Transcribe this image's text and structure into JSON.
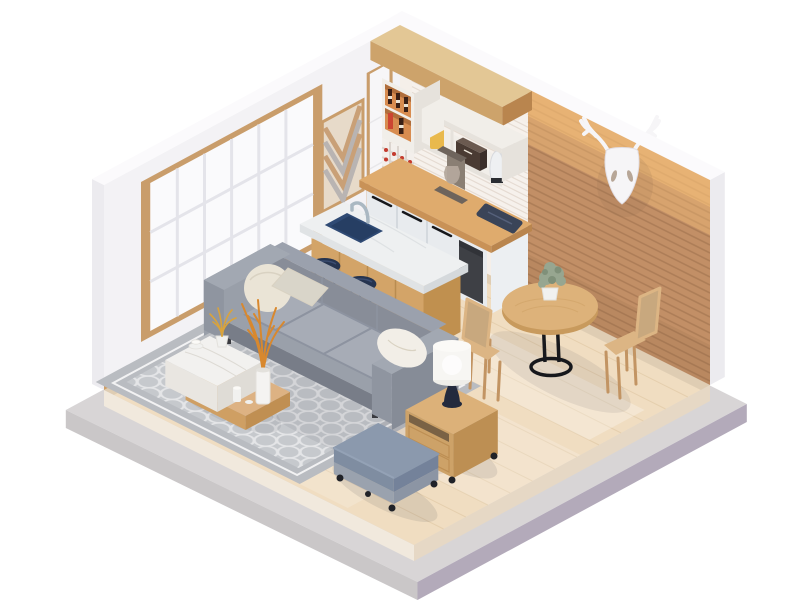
{
  "scene": {
    "title": "Isometric 3D render of a small studio apartment",
    "description": "Low-poly style room with white shoji window wall, brick accent wall, kitchenette, marble island with bar stools, round dining set, gray sofa with pillows, patterned rug, coffee table, ottoman and side table with lamp",
    "background": "#ffffff"
  },
  "objects": {
    "labels": [
      "platform",
      "wood-floor",
      "left-wall",
      "shoji-window",
      "chevron-art",
      "door-panel",
      "kitchen-wall",
      "tile-backsplash",
      "brick-wall",
      "deer-head-decor",
      "kitchen-soffit",
      "corner-shelf",
      "wine-rack",
      "wall-shelf",
      "yellow-canister",
      "bread-box",
      "kettle",
      "kitchen-counter",
      "coffee-maker",
      "serving-tray",
      "mini-fridge",
      "kitchen-island",
      "sink",
      "faucet",
      "bar-stools",
      "area-rug",
      "dining-table",
      "dining-chairs",
      "table-plant",
      "sofa",
      "pillows",
      "coffee-table",
      "vase-with-branches",
      "side-table",
      "table-lamp",
      "ottoman"
    ]
  },
  "colors": {
    "bg": "#ffffff",
    "platform_top": "#d8d5d6",
    "platform_left": "#cac7c8",
    "platform_right": "#b3aaba",
    "floor_top": "#f0ddc1",
    "floor_side_left": "#f1e9dd",
    "floor_side_right": "#e6d8c5",
    "plank": "#e0c8a5",
    "sun": "#ffffff",
    "wall_left": "#f3f2f5",
    "wall_kitchen": "#f5efe9",
    "wall_top": "#fbfafc",
    "wall_outer": "#ecebef",
    "baseboard": "#cf9f67",
    "window_frame": "#c99d6b",
    "pane": "#fafafc",
    "mullion": "#e4e4ea",
    "door_frame": "#c99d6b",
    "door_panel": "#f7f6f8",
    "door_line": "#e8e7ea",
    "chevron_base": "#e7dac9",
    "chevron_wood": "#c9a077",
    "chevron_gray": "#b9b4b2",
    "tile_base": "#f6f1ec",
    "tile_line": "#e5dbd2",
    "brick_base": "#c28f66",
    "brick_line": "#9b6e4b",
    "brick_glow": "#ffc87e",
    "brick_shadow": "#6b4a33",
    "deer_white": "#f6f5f7",
    "deer_line": "#e2dee4",
    "deer_dark": "#a8927e",
    "deer_shadow": "#8a6a4e",
    "soffit_face": "#cda36b",
    "soffit_top": "#e3c795",
    "soffit_end": "#b9854e",
    "shelf_white": "#f1eee9",
    "shelf_side": "#e6e2dc",
    "cubby_orange": "#d88c50",
    "cubby_shadow": "#b06e3c",
    "bottle_dark": "#3a2016",
    "bottle_red": "#cc4532",
    "label_cream": "#ece5d8",
    "rack_white": "#f3efeb",
    "rack_line": "#dcd5cf",
    "rack_dot": "#c43b2e",
    "canister": "#e9b94d",
    "canister_top": "#f3d37c",
    "box_front": "#4a3b33",
    "box_top": "#6b5a50",
    "box_side": "#3a2e29",
    "kettle": "#eef0f2",
    "kettle_dark": "#2a2d33",
    "metal": "#d8dade",
    "cab_front": "#e8ebee",
    "cab_seam": "#d4d9de",
    "handle": "#17181c",
    "cab_side": "#eceff2",
    "counter_top": "#dfab6d",
    "counter_edge": "#c99257",
    "counter_edge2": "#b9854e",
    "appliance": "#3e4045",
    "appliance_dark": "#313338",
    "cm_body": "#8a7f74",
    "cm_dark": "#6e645c",
    "carafe": "#b4a89c",
    "tray": "#3a4458",
    "tray_line": "#55607a",
    "island_wood": "#d3a468",
    "island_seam": "#b98c50",
    "island_end": "#c0904f",
    "marble_top": "#eef0f1",
    "marble_edge": "#e0e3e5",
    "marble_edge2": "#d5d9dc",
    "marble_vein": "#d9dde0",
    "sink": "#2f4a74",
    "sink_dark": "#263e63",
    "faucet": "#aab8c2",
    "stool": "#26344f",
    "stool_hi": "#3b4c70",
    "stool_leg": "#1c2330",
    "rug_base": "#b9bcc1",
    "rug_light": "#c6c9cd",
    "rug_border": "#f2f2f3",
    "rug_pattern": "#e9eaec",
    "shadow": "#4a4a55",
    "sofa_end": "#999fa9",
    "sofa_base": "#787d88",
    "sofa_seat_front": "#9aa0aa",
    "sofa_seat": "#a7acb6",
    "sofa_seam": "#8d93a0",
    "sofa_back": "#888d98",
    "sofa_back_top": "#9ba1ad",
    "arm_top": "#a2a8b2",
    "arm": "#8f95a0",
    "arm_outer": "#868c97",
    "leg_dark": "#3a3b40",
    "pillow_cream": "#eae4d6",
    "pillow_cream_line": "#d9d2c2",
    "pillow_beige": "#d9d5c9",
    "pillow_white": "#f2eee7",
    "ct_marble": "#f2f1ef",
    "ct_front": "#e9e6e1",
    "ct_side": "#dfdcd6",
    "vein": "#dddad4",
    "crate_top": "#ddb283",
    "crate_front": "#cf9f63",
    "crate_side": "#c08f52",
    "pot": "#f1f1ef",
    "grass": "#d9a33c",
    "branch": "#d8882e",
    "vase": "#f4f3f1",
    "vase_line": "#e3e1dc",
    "table_top": "#ddb27a",
    "table_rim": "#c89a5d",
    "table_leg": "#17181c",
    "grain": "#cfa266",
    "chair_wood": "#dcb584",
    "chair_frame": "#c29463",
    "rattan": "#c8a87e",
    "plant": "#97a690",
    "plant_dark": "#7f9079",
    "st_top": "#dcb179",
    "st_front": "#cda268",
    "st_side": "#bd8f53",
    "st_slot": "#6b5740",
    "caster": "#202228",
    "lamp_base": "#232a3d",
    "lamp_shade": "#f7f6f3",
    "lamp_top": "#fbfaf7",
    "lamp_bottom": "#efeee9",
    "ott_top": "#8b99ad",
    "ott_front": "#7f8da1",
    "ott_side": "#74829a",
    "ott_base": "#9aa2ae",
    "ott_base_side": "#8c95a4",
    "ott_line": "#9aa8bc",
    "ao": "#000000"
  }
}
